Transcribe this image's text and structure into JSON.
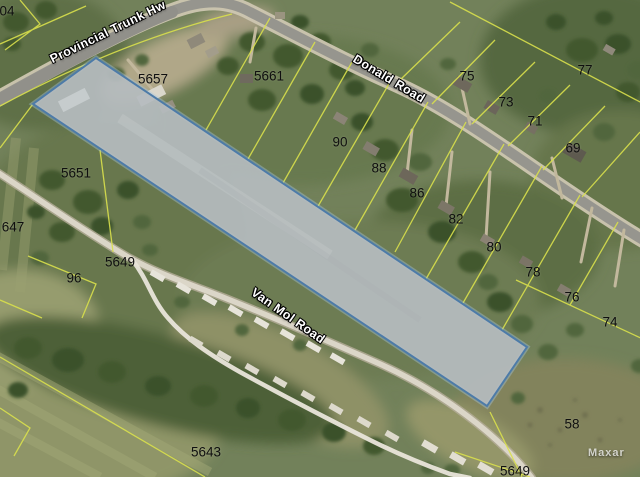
{
  "map": {
    "highlight": {
      "points": "96,58 527,347 487,406 33,104",
      "fill": "#b5bbbe",
      "fill_opacity": "0.93",
      "stroke": "#4d7ba8",
      "halo": "#a5c6e0"
    },
    "road_labels": [
      {
        "text": "Provincial Trunk Hw",
        "x": 108,
        "y": 32,
        "angle": -26
      },
      {
        "text": "Donald Road",
        "x": 389,
        "y": 79,
        "angle": 31
      },
      {
        "text": "Van Mol Road",
        "x": 288,
        "y": 316,
        "angle": 35
      }
    ],
    "parcel_labels": [
      {
        "text": "04",
        "x": 7,
        "y": 11
      },
      {
        "text": "5657",
        "x": 153,
        "y": 79
      },
      {
        "text": "5661",
        "x": 269,
        "y": 76
      },
      {
        "text": "75",
        "x": 467,
        "y": 76
      },
      {
        "text": "77",
        "x": 585,
        "y": 70
      },
      {
        "text": "73",
        "x": 506,
        "y": 102
      },
      {
        "text": "71",
        "x": 535,
        "y": 121
      },
      {
        "text": "69",
        "x": 573,
        "y": 148
      },
      {
        "text": "90",
        "x": 340,
        "y": 142
      },
      {
        "text": "88",
        "x": 379,
        "y": 168
      },
      {
        "text": "5651",
        "x": 76,
        "y": 173
      },
      {
        "text": "86",
        "x": 417,
        "y": 193
      },
      {
        "text": "82",
        "x": 456,
        "y": 219
      },
      {
        "text": "647",
        "x": 13,
        "y": 227
      },
      {
        "text": "80",
        "x": 494,
        "y": 247
      },
      {
        "text": "5649",
        "x": 120,
        "y": 262
      },
      {
        "text": "78",
        "x": 533,
        "y": 272
      },
      {
        "text": "96",
        "x": 74,
        "y": 278
      },
      {
        "text": "76",
        "x": 572,
        "y": 297
      },
      {
        "text": "74",
        "x": 610,
        "y": 322
      },
      {
        "text": "58",
        "x": 572,
        "y": 424
      },
      {
        "text": "5643",
        "x": 206,
        "y": 452
      },
      {
        "text": "5649",
        "x": 515,
        "y": 471
      }
    ],
    "watermark": {
      "text": "Maxar"
    },
    "palette": {
      "parcel_line": "#d9e04c",
      "road_fill": "#96958e",
      "road_casing": "#cec6b1"
    }
  }
}
